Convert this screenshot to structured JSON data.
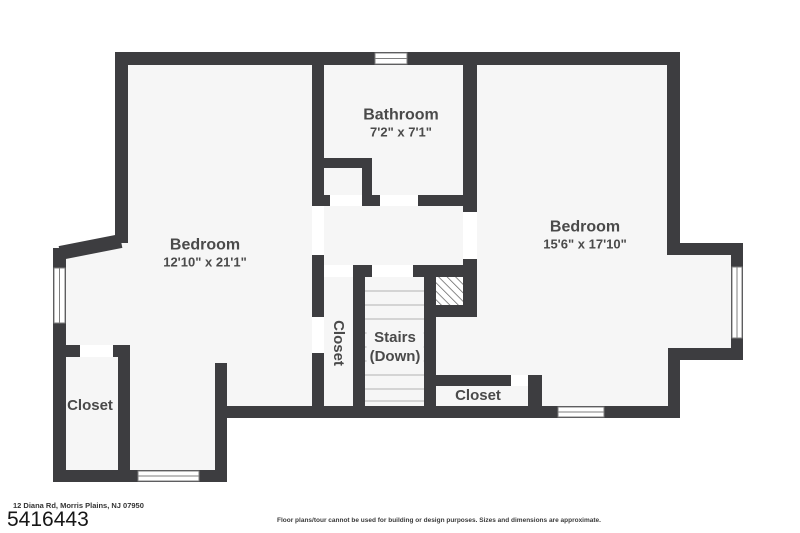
{
  "plan": {
    "rooms": {
      "bathroom": {
        "name": "Bathroom",
        "dims": "7'2\" x 7'1\""
      },
      "bedroom_left": {
        "name": "Bedroom",
        "dims": "12'10\" x 21'1\""
      },
      "bedroom_right": {
        "name": "Bedroom",
        "dims": "15'6\" x 17'10\""
      },
      "stairs": {
        "name": "Stairs",
        "direction": "(Down)"
      },
      "closet_left": {
        "name": "Closet"
      },
      "closet_center": {
        "name": "Closet"
      },
      "closet_right": {
        "name": "Closet"
      }
    }
  },
  "footer": {
    "address": "12 Diana Rd, Morris Plains, NJ 07950",
    "mls_number": "5416443",
    "disclaimer": "Floor plans/tour cannot be used for building or design purposes. Sizes and dimensions are approximate."
  },
  "colors": {
    "wall": "#3d3d40",
    "interior": "#f6f6f6",
    "outside": "#ffffff",
    "label": "#4a4a4a"
  }
}
